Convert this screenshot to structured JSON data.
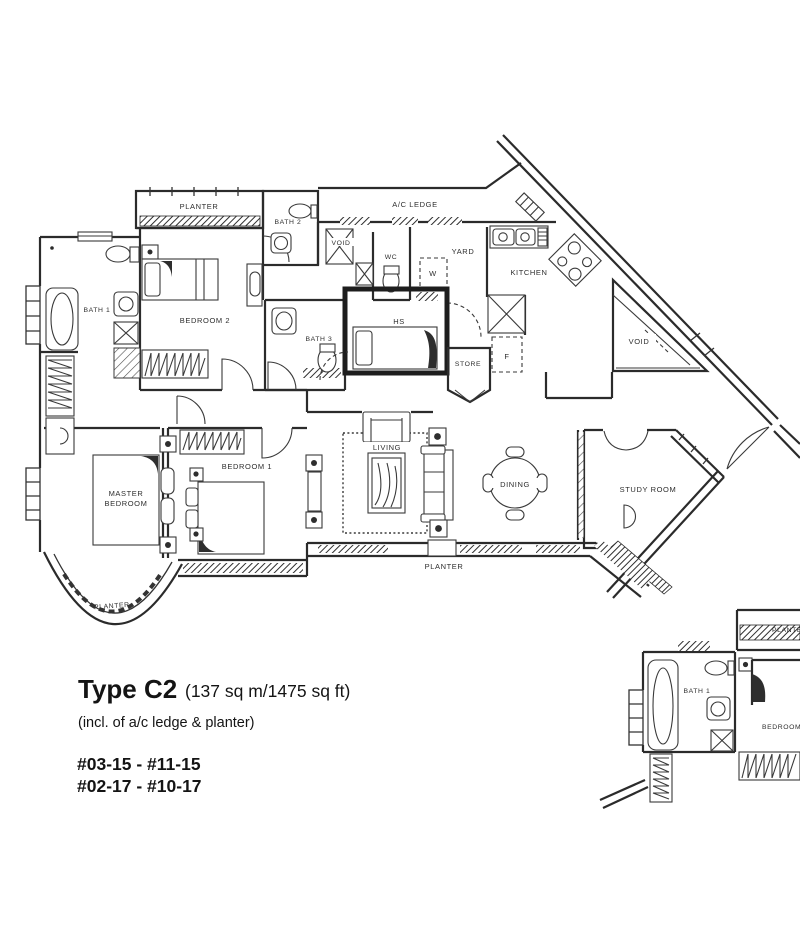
{
  "plan": {
    "title": {
      "type": "Type C2",
      "area": "(137 sq m/1475 sq ft)",
      "note": "(incl. of a/c ledge & planter)",
      "units_line1": "#03-15 - #11-15",
      "units_line2": "#02-17 - #10-17"
    },
    "labels": {
      "planter_top": "PLANTER",
      "bath2": "BATH 2",
      "ac_ledge": "A/C LEDGE",
      "void_shaft": "VOID",
      "wc": "WC",
      "yard": "YARD",
      "washer": "W",
      "kitchen": "KITCHEN",
      "bath1": "BATH 1",
      "bedroom2": "BEDROOM 2",
      "bath3": "BATH 3",
      "hs": "HS",
      "store": "STORE",
      "fridge": "F",
      "void_large": "VOID",
      "master_line1": "MASTER",
      "master_line2": "BEDROOM",
      "bedroom1": "BEDROOM 1",
      "living": "LIVING",
      "dining": "DINING",
      "study": "STUDY ROOM",
      "planter_bottom": "PLANTER",
      "planter_curved": "PLANTER"
    },
    "mini": {
      "planter": "PLANTER",
      "bath1": "BATH 1",
      "bedroom": "BEDROOM 2"
    },
    "colors": {
      "ink": "#2b2b2b",
      "paper": "#ffffff"
    }
  }
}
